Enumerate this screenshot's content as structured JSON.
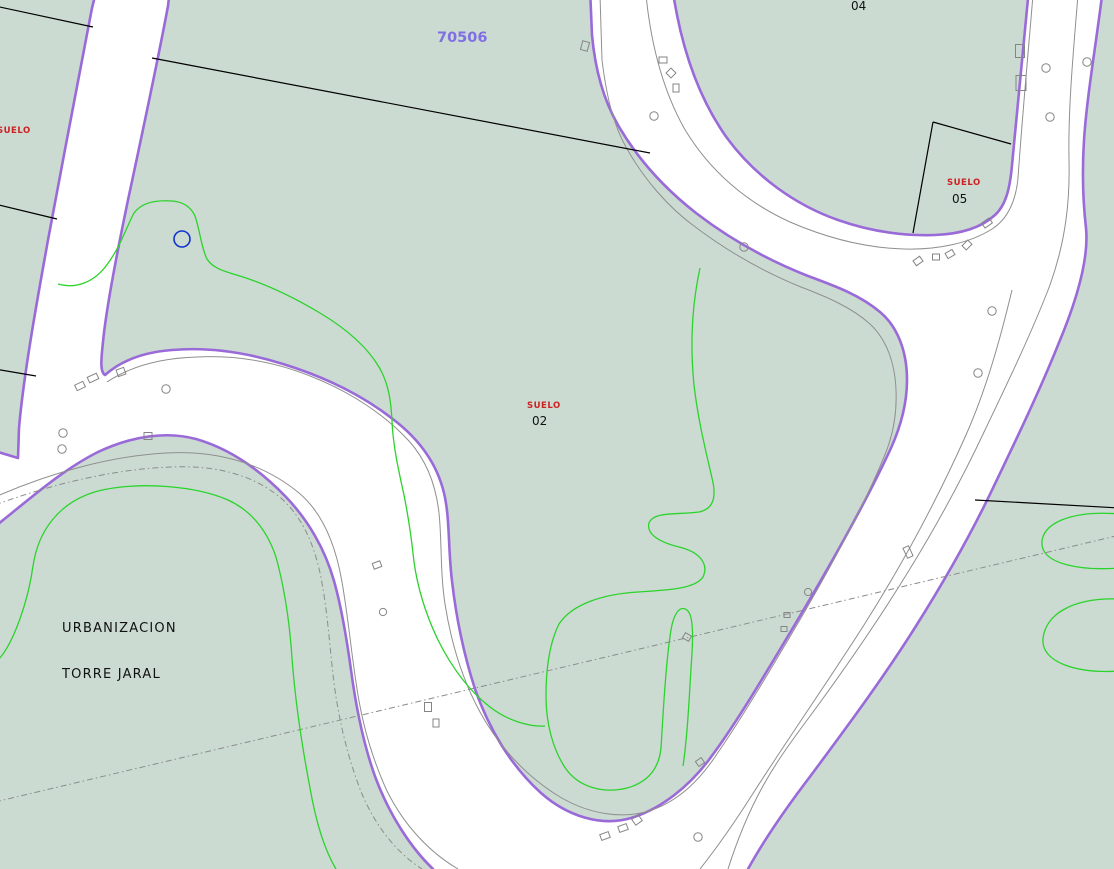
{
  "map": {
    "primary_parcel_number": "70506",
    "labels": {
      "left_suelo": "SUELO",
      "suelo02": {
        "title": "SUELO",
        "number": "02"
      },
      "suelo05": {
        "title": "SUELO",
        "number": "05"
      },
      "parcel04_number": "04",
      "urbanization_line1": "URBANIZACION",
      "urbanization_line2": "TORRE JARAL"
    },
    "colors": {
      "parcel_fill": "#cbdbd2",
      "parcel_border_purple": "#9a6ad8",
      "road_fill": "#ffffff",
      "contour_green": "#2bd32b",
      "curb_gray": "#8f8f8f",
      "boundary_black": "#000000",
      "suelo_red": "#cc2222",
      "parcel_number_purple": "#7f6fe3",
      "marker_blue": "#1133cc"
    }
  }
}
